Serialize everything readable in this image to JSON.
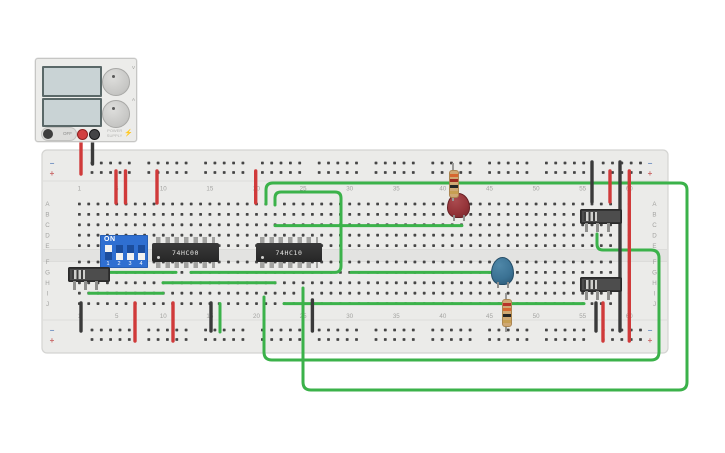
{
  "colors": {
    "wire_red": "#d03a3a",
    "wire_black": "#3a3a3a",
    "wire_green": "#3bb24a",
    "board": "#ebebe9",
    "board_border": "#d4d4d2",
    "channel": "#e3e3e1",
    "hole": "#454545",
    "label_gray": "#a3a3a1",
    "rail_neg_color": "#6f8fc0",
    "rail_pos_color": "#c96a6a"
  },
  "power_supply": {
    "toggle_label": "OFF",
    "caption_line1": "POWER",
    "caption_line2": "SUPPLY",
    "bolt": "⚡",
    "knob_top_label": "V",
    "knob_bottom_label": "A"
  },
  "breadboard": {
    "rail_negative_label": "−",
    "rail_positive_label": "+",
    "row_labels": [
      "A",
      "B",
      "C",
      "D",
      "E",
      "F",
      "G",
      "H",
      "I",
      "J"
    ],
    "column_numbers": [
      "1",
      "5",
      "10",
      "15",
      "20",
      "25",
      "30",
      "35",
      "40",
      "45",
      "50",
      "55",
      "60"
    ]
  },
  "components": {
    "dip_switch": {
      "label": "ON",
      "positions": [
        "1",
        "2",
        "3",
        "4"
      ],
      "states": [
        "on",
        "off",
        "off",
        "off"
      ]
    },
    "ic1_label": "74HC00",
    "ic2_label": "74HC10",
    "resistor_top_bands": [
      "#d7672f",
      "#9e2b20",
      "#262626",
      "#c79f52"
    ],
    "resistor_bottom_bands": [
      "#b8342a",
      "#d7672f",
      "#262626",
      "#c79f52"
    ]
  },
  "wires": {
    "red": [
      "M81,141 L81,174",
      "M116,171 L116,203",
      "M125.5,171 L125.5,203",
      "M157,171 L157,203",
      "M255.7,171 L255.7,203",
      "M610,171 L610,202",
      "M629.3,171 L629.3,341",
      "M603,303 L603,341",
      "M135,303 L135,341",
      "M173,303 L173,341"
    ],
    "black": [
      "M92.5,141 L92.5,164",
      "M592,162 L592,202",
      "M620,162 L620,331",
      "M81,303 L81,331",
      "M211,303 L211,331",
      "M312.4,300 L312.4,331",
      "M596,303 L596,331"
    ],
    "green": [
      "M107,272.4 L176,272.4",
      "M163,282.8 L275,282.8",
      "M89,293.2 L163,293.2",
      "M284,303.6 L584,303.6",
      "M275,225.6 L461.9,225.6",
      "M351,272.4 L497,272.4",
      "M220,303.6 L220,332",
      "M275,205 L275,198 Q275,192 281,192 L335,192 Q341,192 341,198 L341,266 Q341,272.4 335,272.4 L191,272.4",
      "M597,234 L597,244 Q597,250 603,250 L651,250 Q659,250 659,258 L659,352 Q659,360 651,360 L272,360 Q264,360 264,352 L264,297",
      "M266,204 L266,190 Q266,183 273,183 L680,183 Q687,183 687,190 L687,382 Q687,390 679,390 L311,390 Q303,390 303,382 L303,288"
    ]
  }
}
